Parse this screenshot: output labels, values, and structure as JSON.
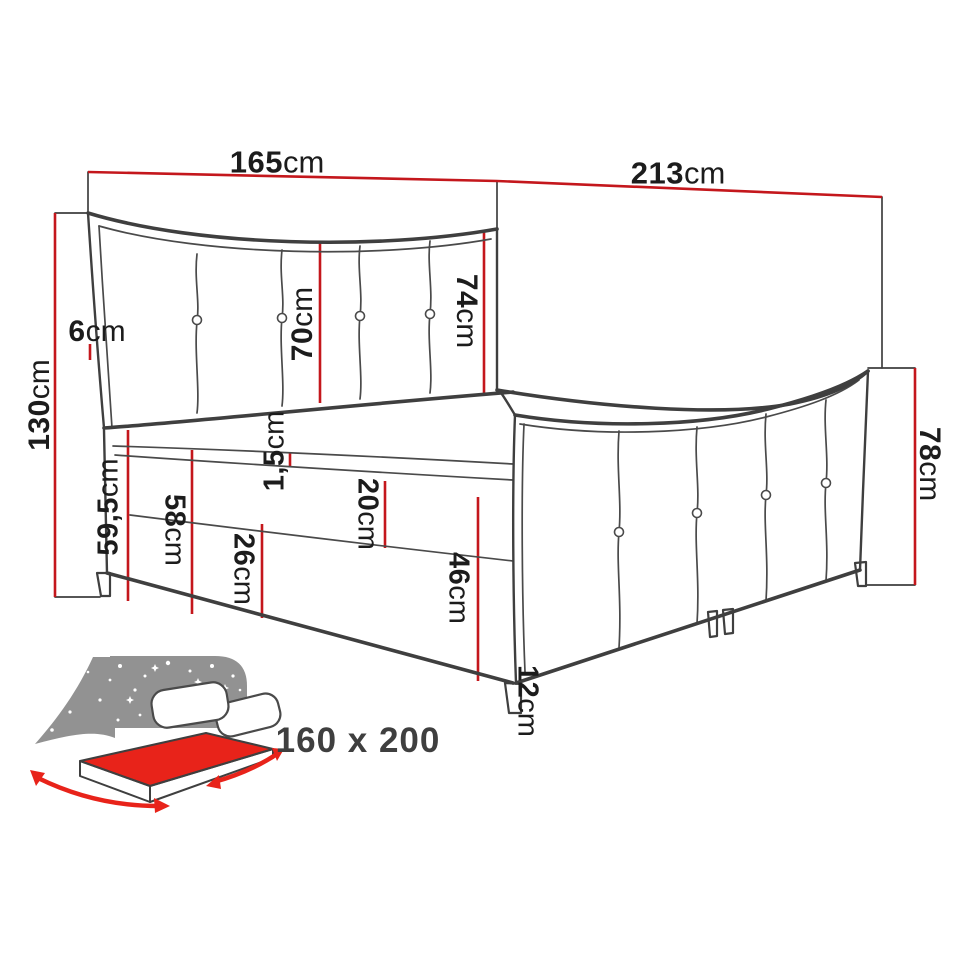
{
  "diagram": {
    "type": "furniture-dimension-drawing",
    "subject": "upholstered boxspring bed with curved tufted headboard and footboard",
    "dimensions": {
      "width_top": {
        "value": "165",
        "unit": "cm"
      },
      "length_top": {
        "value": "213",
        "unit": "cm"
      },
      "total_height_left": {
        "value": "130",
        "unit": "cm"
      },
      "headboard_frame": {
        "value": "6",
        "unit": "cm"
      },
      "headboard_inner_left": {
        "value": "70",
        "unit": "cm"
      },
      "headboard_inner_right": {
        "value": "74",
        "unit": "cm"
      },
      "mattress_top_height": {
        "value": "59,5",
        "unit": "cm"
      },
      "base_top_height": {
        "value": "58",
        "unit": "cm"
      },
      "base_front_left": {
        "value": "26",
        "unit": "cm"
      },
      "topper_thickness": {
        "value": "1,5",
        "unit": "cm"
      },
      "mattress_thickness": {
        "value": "20",
        "unit": "cm"
      },
      "base_front_right": {
        "value": "46",
        "unit": "cm"
      },
      "leg_height": {
        "value": "12",
        "unit": "cm"
      },
      "footboard_height": {
        "value": "78",
        "unit": "cm"
      }
    },
    "size_label": "160 x 200",
    "icons": {
      "bed_size_icon": "bed-with-starry-headboard-and-red-mattress-arrows"
    },
    "colors": {
      "dimension_red": "#c4171c",
      "outline_dark": "#3f3f3f",
      "icon_gray": "#929292",
      "icon_red": "#e8231a",
      "background": "#ffffff"
    }
  }
}
